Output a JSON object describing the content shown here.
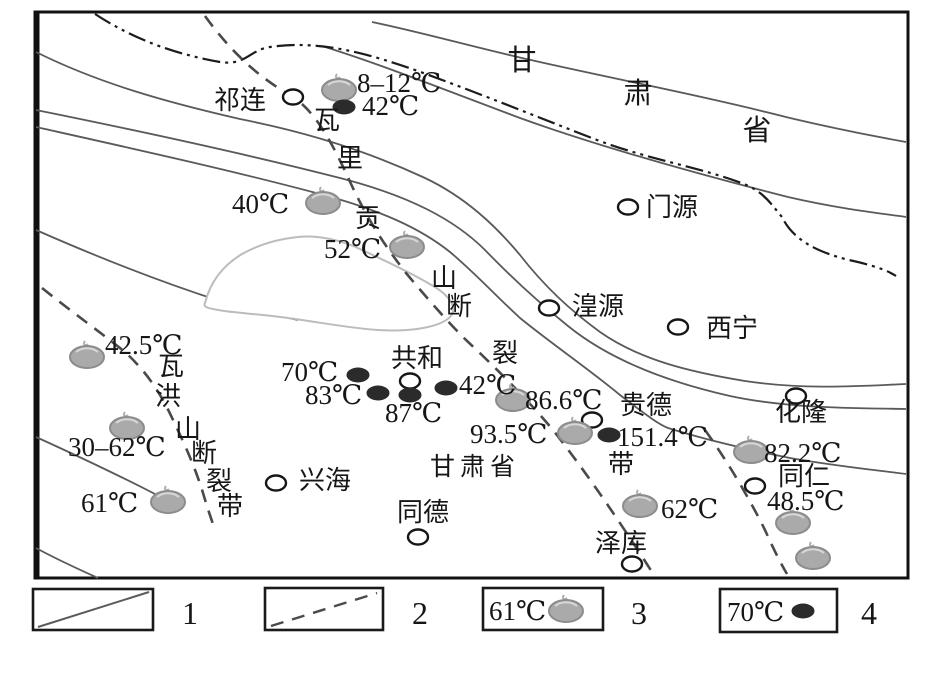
{
  "map": {
    "province_top": {
      "char1": "甘",
      "char2": "肃",
      "char3": "省"
    },
    "region_bottom": "甘肃省",
    "towns": {
      "qilian": "祁连",
      "menyuan": "门源",
      "huangyuan": "湟源",
      "xining": "西宁",
      "gonghe": "共和",
      "guide": "贵德",
      "hualong": "化隆",
      "tongren": "同仁",
      "xinghai": "兴海",
      "tongde": "同德",
      "zeku": "泽库"
    },
    "temperatures": {
      "t8_12": "8–12℃",
      "t42a": "42℃",
      "t40": "40℃",
      "t52": "52℃",
      "t42_5": "42.5℃",
      "t70": "70℃",
      "t83": "83℃",
      "t87": "87℃",
      "t42b": "42℃",
      "t86_6": "86.6℃",
      "t93_5": "93.5℃",
      "t151_4": "151.4℃",
      "t30_62": "30–62℃",
      "t61": "61℃",
      "t82_2": "82.2℃",
      "t48_5": "48.5℃",
      "t62": "62℃"
    },
    "faults": {
      "waligong": {
        "c0": "瓦",
        "c1": "里",
        "c2": "贡",
        "c3": "山",
        "c4": "断",
        "c5": "裂",
        "c6": "带"
      },
      "wahong": {
        "c0": "瓦",
        "c1": "洪",
        "c2": "山",
        "c3": "断",
        "c4": "裂",
        "c5": "带"
      }
    }
  },
  "legend": {
    "item1_num": "1",
    "item2_num": "2",
    "item3_num": "3",
    "item4_num": "4",
    "item3_label": "61℃",
    "item4_label": "70℃"
  },
  "colors": {
    "spring_fill": "#aaaaaa",
    "spring_edge": "#8c8c8c",
    "black_dot": "#2b2b2b",
    "geo_line": "#5a5a5a",
    "fault_line": "#4a4a4a",
    "boundary_line": "#1c1c1c",
    "lake_outline": "#bcbcbc"
  }
}
